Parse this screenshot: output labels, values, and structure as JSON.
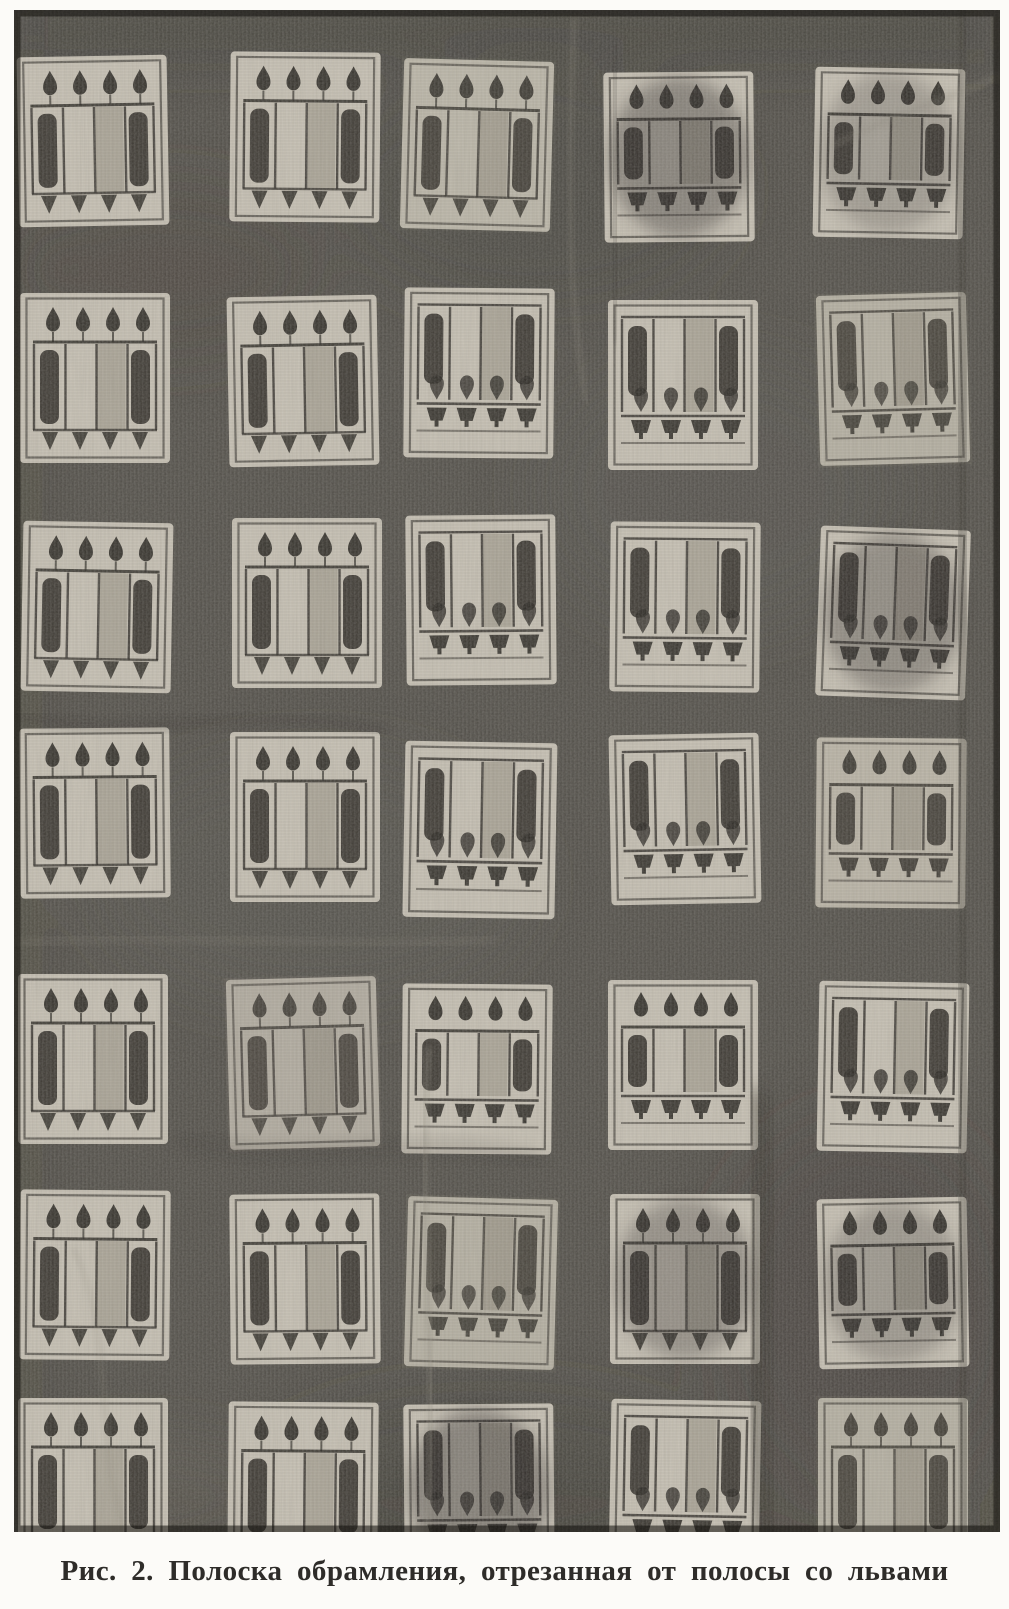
{
  "figure": {
    "label": "Рис. 2.",
    "caption": "Рис. 2. Полоска обрамления, отрезанная от полосы со львами"
  },
  "artwork": {
    "type": "black-and-white photograph of a woven textile band",
    "grid": {
      "rows": 7,
      "cols": 5
    },
    "motif_variants": {
      "A": "buds-top-fringe-bottom",
      "B": "bars-top-cups-bottom",
      "C": "buds-top-cups-bottom"
    },
    "palette": {
      "paper": "#fcfbf8",
      "fabric": "#53504a",
      "tile_light": "#c9c3b6",
      "tile_mid": "#a39d8f",
      "ink_dark": "#2b2823",
      "shade_overlay": "#767166",
      "damage_overlay": "#262420",
      "caption_color": "#2e2c29"
    },
    "tiles": [
      {
        "x": 4,
        "y": 46,
        "v": "A",
        "rot": -1
      },
      {
        "x": 216,
        "y": 42,
        "v": "A",
        "rot": 0.5
      },
      {
        "x": 388,
        "y": 50,
        "v": "A",
        "rot": 1.5,
        "shade": 0.12
      },
      {
        "x": 590,
        "y": 62,
        "v": "C",
        "rot": -0.5,
        "dark": 0.38
      },
      {
        "x": 800,
        "y": 58,
        "v": "C",
        "rot": 1,
        "dark": 0.22
      },
      {
        "x": 6,
        "y": 283,
        "v": "A",
        "rot": 0
      },
      {
        "x": 214,
        "y": 286,
        "v": "A",
        "rot": -1
      },
      {
        "x": 390,
        "y": 278,
        "v": "B",
        "rot": 0.5
      },
      {
        "x": 594,
        "y": 290,
        "v": "B",
        "rot": 0
      },
      {
        "x": 804,
        "y": 284,
        "v": "B",
        "rot": -1.5,
        "shade": 0.2
      },
      {
        "x": 8,
        "y": 512,
        "v": "A",
        "rot": 1
      },
      {
        "x": 218,
        "y": 508,
        "v": "A",
        "rot": 0
      },
      {
        "x": 392,
        "y": 505,
        "v": "B",
        "rot": -0.5
      },
      {
        "x": 596,
        "y": 512,
        "v": "B",
        "rot": 0.5
      },
      {
        "x": 804,
        "y": 518,
        "v": "B",
        "rot": 2,
        "dark": 0.33
      },
      {
        "x": 6,
        "y": 718,
        "v": "A",
        "rot": -0.5
      },
      {
        "x": 216,
        "y": 722,
        "v": "A",
        "rot": 0
      },
      {
        "x": 390,
        "y": 732,
        "v": "B",
        "rot": 1,
        "w": 152,
        "h": 176
      },
      {
        "x": 596,
        "y": 724,
        "v": "B",
        "rot": -1
      },
      {
        "x": 802,
        "y": 728,
        "v": "C",
        "rot": 0.5,
        "shade": 0.15
      },
      {
        "x": 4,
        "y": 964,
        "v": "A",
        "rot": 0
      },
      {
        "x": 214,
        "y": 968,
        "v": "A",
        "rot": -1.5,
        "shade": 0.25
      },
      {
        "x": 388,
        "y": 974,
        "v": "C",
        "rot": 0.5
      },
      {
        "x": 594,
        "y": 970,
        "v": "C",
        "rot": 0
      },
      {
        "x": 804,
        "y": 972,
        "v": "B",
        "rot": 1
      },
      {
        "x": 6,
        "y": 1180,
        "v": "A",
        "rot": 0.5
      },
      {
        "x": 216,
        "y": 1184,
        "v": "A",
        "rot": -0.5
      },
      {
        "x": 392,
        "y": 1188,
        "v": "B",
        "rot": 1.5,
        "shade": 0.2
      },
      {
        "x": 596,
        "y": 1184,
        "v": "A",
        "rot": 0,
        "dark": 0.3
      },
      {
        "x": 804,
        "y": 1188,
        "v": "C",
        "rot": -1,
        "dark": 0.25
      },
      {
        "x": 4,
        "y": 1388,
        "v": "A",
        "rot": 0
      },
      {
        "x": 214,
        "y": 1392,
        "v": "A",
        "rot": 0.5
      },
      {
        "x": 390,
        "y": 1394,
        "v": "B",
        "rot": -0.5,
        "dark": 0.4
      },
      {
        "x": 596,
        "y": 1390,
        "v": "B",
        "rot": 1
      },
      {
        "x": 804,
        "y": 1388,
        "v": "A",
        "rot": 0,
        "shade": 0.2
      }
    ]
  }
}
